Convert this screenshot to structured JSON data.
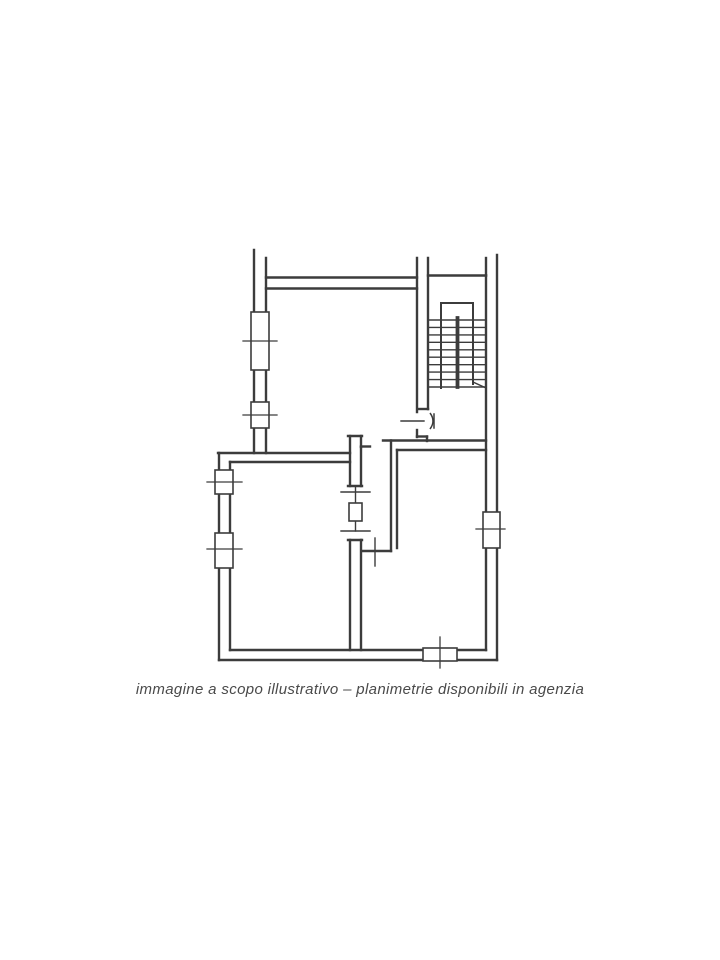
{
  "page": {
    "background": "#ffffff"
  },
  "caption": {
    "text": "immagine a scopo illustrativo – planimetrie disponibili in agenzia",
    "color": "#4a4a4a"
  },
  "floorplan": {
    "ink": "#3c3c3c",
    "background": "#ffffff",
    "style": {
      "wall_width": 2.4,
      "medium_width": 2.0,
      "thin_width": 1.4,
      "window_stroke": 1.6,
      "tick_width": 1.3,
      "spine_width": 3.8
    },
    "walls": [
      [
        254,
        250,
        254,
        453
      ],
      [
        266,
        258,
        266,
        453
      ],
      [
        266,
        277.5,
        417,
        277.5
      ],
      [
        266,
        288.5,
        417,
        288.5
      ],
      [
        417,
        258,
        417,
        412
      ],
      [
        428,
        258,
        428,
        409
      ],
      [
        419,
        409,
        428,
        409
      ],
      [
        428,
        275.5,
        486,
        275.5
      ],
      [
        486,
        258,
        486,
        275.5
      ],
      [
        497,
        255,
        497,
        660
      ],
      [
        486,
        275.5,
        486,
        512
      ],
      [
        486,
        548,
        486,
        650
      ],
      [
        417,
        430,
        417,
        437
      ],
      [
        417,
        436.5,
        427,
        436.5
      ],
      [
        427,
        436.5,
        427,
        441
      ],
      [
        383,
        440.5,
        486,
        440.5
      ],
      [
        397,
        450,
        486,
        450
      ],
      [
        391,
        440.5,
        391,
        551
      ],
      [
        397,
        450,
        397,
        548
      ],
      [
        362,
        551,
        391,
        551
      ],
      [
        348,
        436,
        362,
        436
      ],
      [
        350,
        436,
        350,
        486
      ],
      [
        361,
        436,
        361,
        447
      ],
      [
        361,
        446.5,
        370,
        446.5
      ],
      [
        361,
        447,
        361,
        486
      ],
      [
        348,
        486,
        362,
        486
      ],
      [
        348,
        540,
        362,
        540
      ],
      [
        350,
        540,
        350,
        650
      ],
      [
        361,
        540,
        361,
        650
      ],
      [
        218,
        453,
        350,
        453
      ],
      [
        230,
        462,
        350,
        462
      ],
      [
        219,
        453,
        219,
        660
      ],
      [
        230,
        462,
        230,
        650
      ],
      [
        230,
        650,
        486,
        650
      ],
      [
        219,
        660,
        497,
        660
      ]
    ],
    "thin_lines": [
      [
        401,
        421,
        424,
        421
      ],
      [
        375,
        538,
        375,
        566
      ],
      [
        341,
        492,
        370,
        492
      ],
      [
        341,
        531,
        370,
        531
      ],
      [
        355.5,
        486,
        355.5,
        503
      ],
      [
        355.5,
        521,
        355.5,
        531
      ],
      [
        473,
        382,
        486,
        388
      ]
    ],
    "pocket_door_rect": [
      349,
      503,
      13,
      18
    ],
    "windows": [
      {
        "name": "window-upper-left-1",
        "rect": [
          251,
          312,
          18,
          58
        ],
        "tick": [
          243,
          341,
          277,
          341
        ]
      },
      {
        "name": "window-upper-left-2",
        "rect": [
          251,
          402,
          18,
          26
        ],
        "tick": [
          243,
          415,
          277,
          415
        ]
      },
      {
        "name": "window-lower-left-1",
        "rect": [
          215,
          470,
          18,
          24
        ],
        "tick": [
          207,
          482,
          242,
          482
        ]
      },
      {
        "name": "window-lower-left-2",
        "rect": [
          215,
          533,
          18,
          35
        ],
        "tick": [
          207,
          549,
          242,
          549
        ]
      },
      {
        "name": "window-bottom",
        "rect": [
          423,
          648,
          34,
          13
        ],
        "tick": [
          440,
          637,
          440,
          668
        ]
      },
      {
        "name": "window-right",
        "rect": [
          483,
          512,
          17,
          36
        ],
        "tick": [
          476,
          529,
          505,
          529
        ]
      }
    ],
    "stairs": {
      "rails": [
        [
          441,
          303,
          441,
          388
        ],
        [
          473,
          303,
          473,
          384
        ],
        [
          441,
          303,
          473,
          303
        ]
      ],
      "tread_x1": 428,
      "tread_x2": 486,
      "tread_y_start": 320,
      "tread_y_end": 387,
      "tread_count": 10,
      "spine": [
        457.5,
        318,
        457.5,
        387
      ]
    },
    "entry_door_leaf": {
      "arc_path": "M430,413 Q436,421 430,429",
      "post": [
        434,
        414,
        434,
        428
      ]
    }
  }
}
